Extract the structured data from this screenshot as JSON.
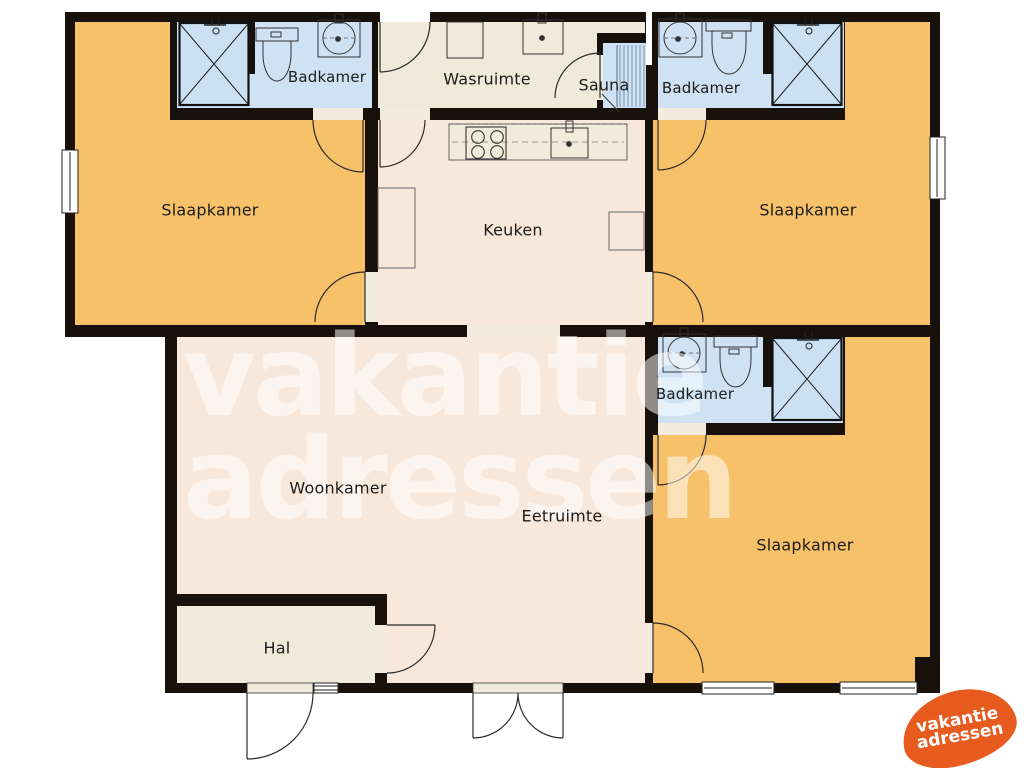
{
  "rooms": [
    {
      "id": "slaapkamer-left",
      "label": "Slaapkamer"
    },
    {
      "id": "slaapkamer-right",
      "label": "Slaapkamer"
    },
    {
      "id": "slaapkamer-bottom-right",
      "label": "Slaapkamer"
    },
    {
      "id": "badkamer-top-left",
      "label": "Badkamer"
    },
    {
      "id": "badkamer-top-right",
      "label": "Badkamer"
    },
    {
      "id": "badkamer-middle-right",
      "label": "Badkamer"
    },
    {
      "id": "wasruimte",
      "label": "Wasruimte"
    },
    {
      "id": "sauna",
      "label": "Sauna"
    },
    {
      "id": "keuken",
      "label": "Keuken"
    },
    {
      "id": "woonkamer",
      "label": "Woonkamer"
    },
    {
      "id": "eetruimte",
      "label": "Eetruimte"
    },
    {
      "id": "hal",
      "label": "Hal"
    }
  ],
  "watermark": {
    "line1": "vakantie",
    "line2": "adressen"
  },
  "logo": {
    "line1": "vakantie",
    "line2": "adressen"
  },
  "fixtures": [
    "shower",
    "toilet",
    "sink",
    "washing-machine",
    "stove",
    "kitchen-sink",
    "sauna-bench",
    "door",
    "window"
  ],
  "colors": {
    "wall": "#17100b",
    "bedroom": "#f6c169",
    "bathroom": "#cee2f4",
    "laundry": "#f0eadb",
    "living": "#f8e8db",
    "opening": "#f2ecdf",
    "counter": "#f1ebdc",
    "sauna_line": "#8fa6bc",
    "watermark": "rgba(255,255,255,0.52)",
    "logo": "#e75b1e",
    "label": "#1c1c1c"
  }
}
